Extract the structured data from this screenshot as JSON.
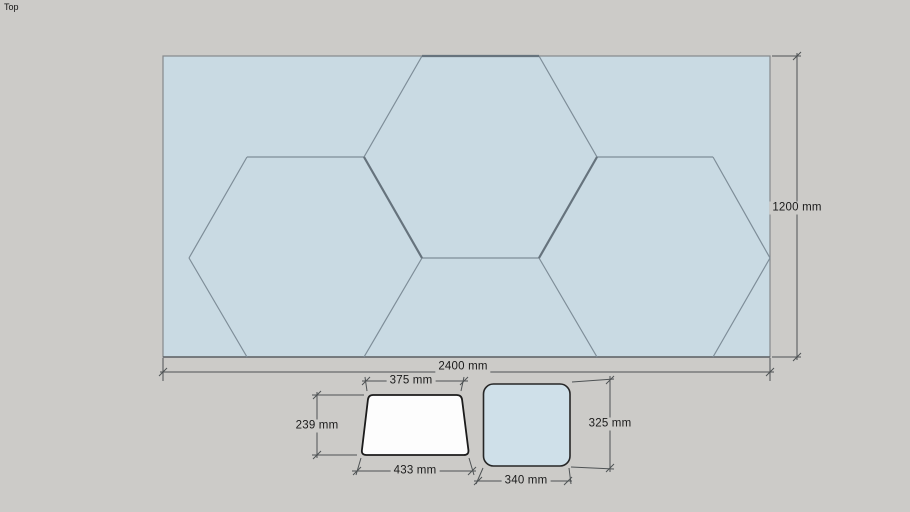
{
  "canvas": {
    "view_label": "Top",
    "background_color": "#cccbc8"
  },
  "panel": {
    "description": "hexagon-tiled rectangular panel, top view",
    "fill_color": "#c9dae3",
    "edge_color": "#7e8d98",
    "profile_edge_color": "#66737d",
    "dimensions": {
      "width": "2400 mm",
      "height": "1200 mm"
    }
  },
  "trapezoid_tile": {
    "description": "half-hexagon tile, top view",
    "fill_color": "#fdfdfd",
    "outline_color": "#1b1b1b",
    "dimensions": {
      "top_width": "375 mm",
      "height": "239 mm",
      "bottom_width": "433 mm"
    }
  },
  "square_tile": {
    "description": "rounded square tile, top view",
    "fill_color": "#cfe0e9",
    "outline_color": "#262626",
    "dimensions": {
      "width": "340 mm",
      "height": "325 mm"
    }
  }
}
